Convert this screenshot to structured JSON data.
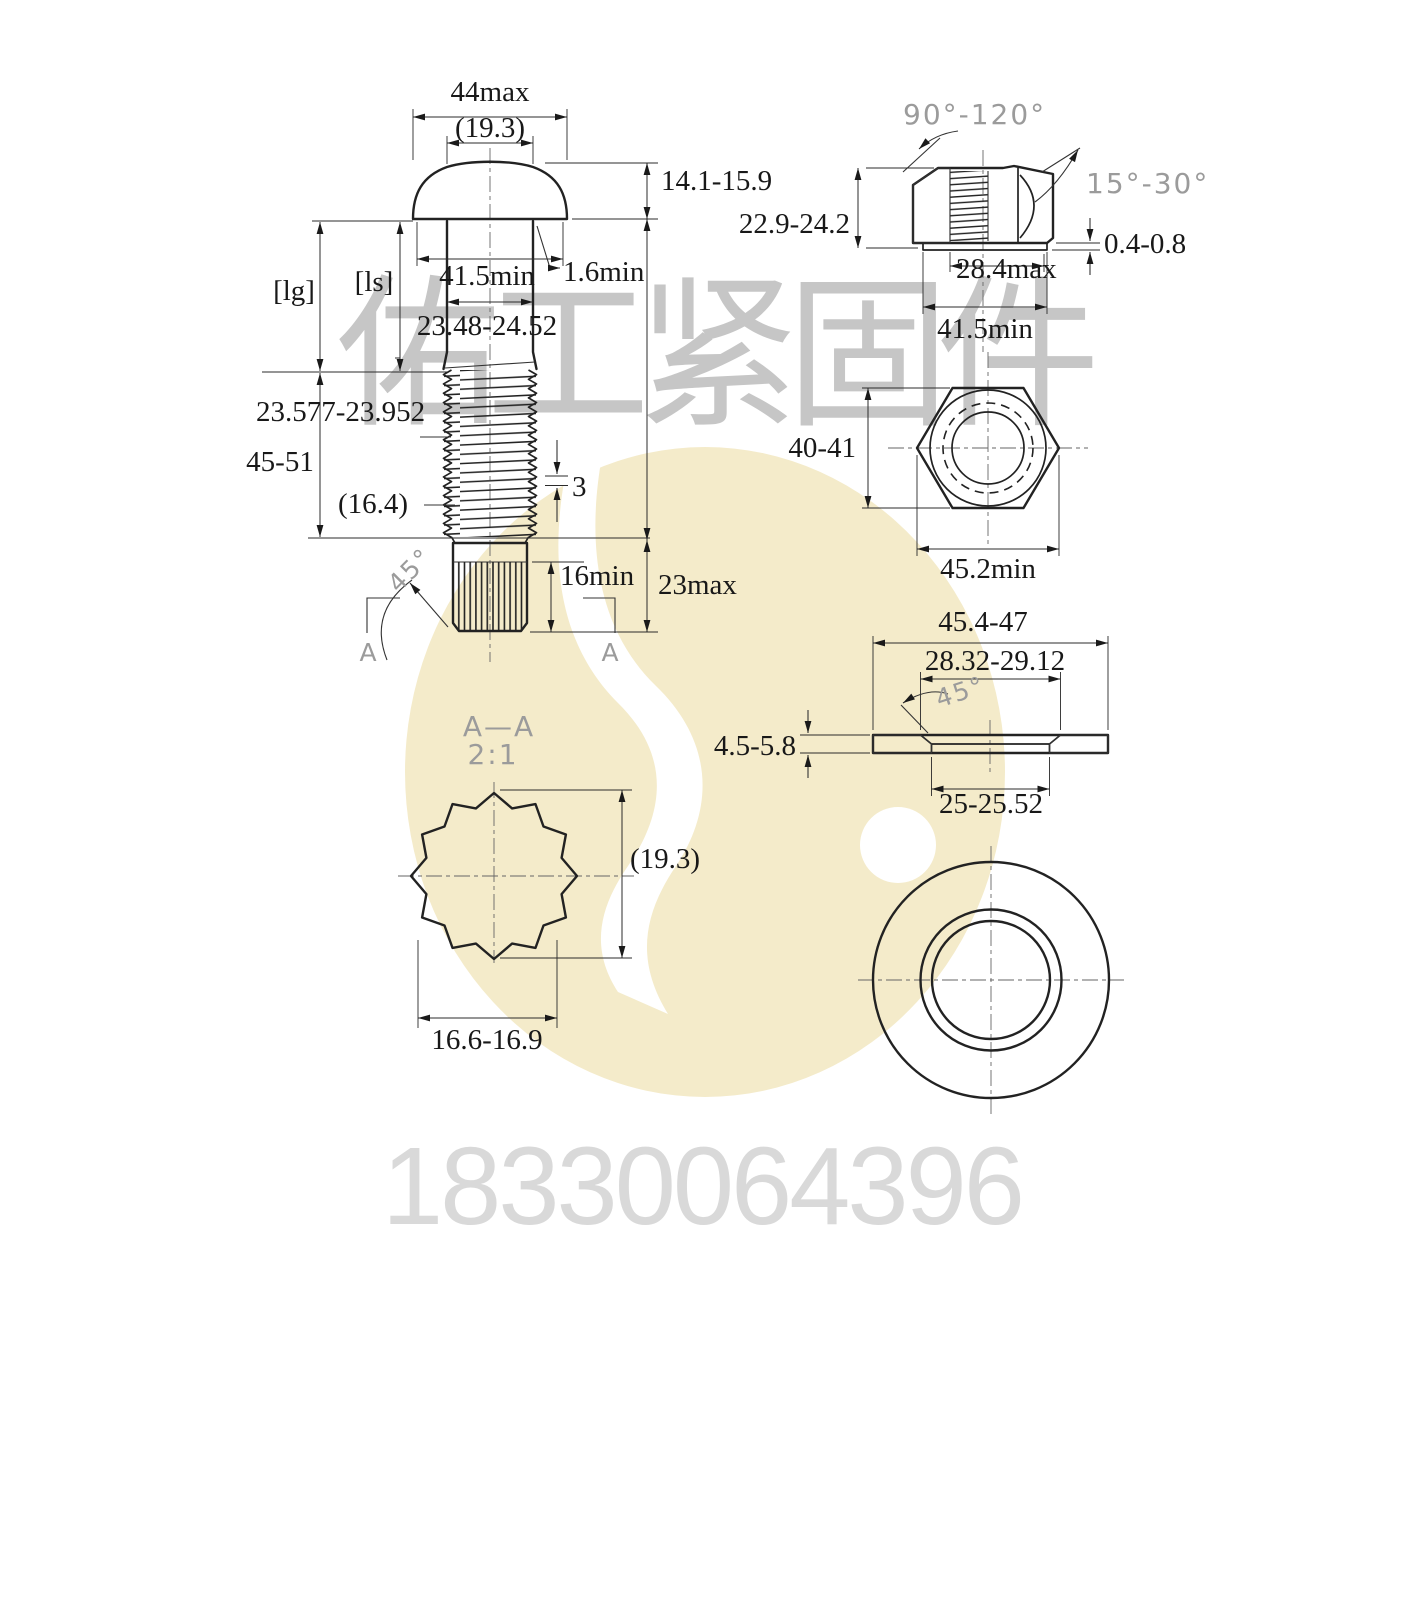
{
  "watermark": {
    "company": "佑工紧固件",
    "phone": "18330064396",
    "logo_color": "#f4ebca"
  },
  "bolt": {
    "head_width_max": "44max",
    "head_ref_dia": "(19.3)",
    "head_height": "14.1-15.9",
    "bearing_dia_min": "41.5min",
    "fillet_min": "1.6min",
    "shank_dia": "23.48-24.52",
    "grip_label": "[lg]",
    "shank_label": "[ls]",
    "thread_major_dia": "23.577-23.952",
    "thread_length": "45-51",
    "thread_minor_ref": "(16.4)",
    "thread_pitch": "3",
    "tip_chamfer_angle": "45°",
    "spline_length_min": "16min",
    "tip_length_max": "23max",
    "section_label_left": "A",
    "section_label_right": "A"
  },
  "nut": {
    "countersink_angle": "90°-120°",
    "chamfer_angle": "15°-30°",
    "height": "22.9-24.2",
    "washer_face_height": "0.4-0.8",
    "thread_dia_max": "28.4max",
    "washer_face_dia_min": "41.5min",
    "across_flats": "40-41",
    "across_corners_min": "45.2min"
  },
  "washer": {
    "outer_dia": "45.4-47",
    "chamfer_dia": "28.32-29.12",
    "chamfer_angle": "45°",
    "thickness": "4.5-5.8",
    "inner_dia": "25-25.52"
  },
  "section": {
    "title": "A—A",
    "scale": "2:1",
    "spline_ref_dia": "(19.3)",
    "spline_width": "16.6-16.9"
  }
}
